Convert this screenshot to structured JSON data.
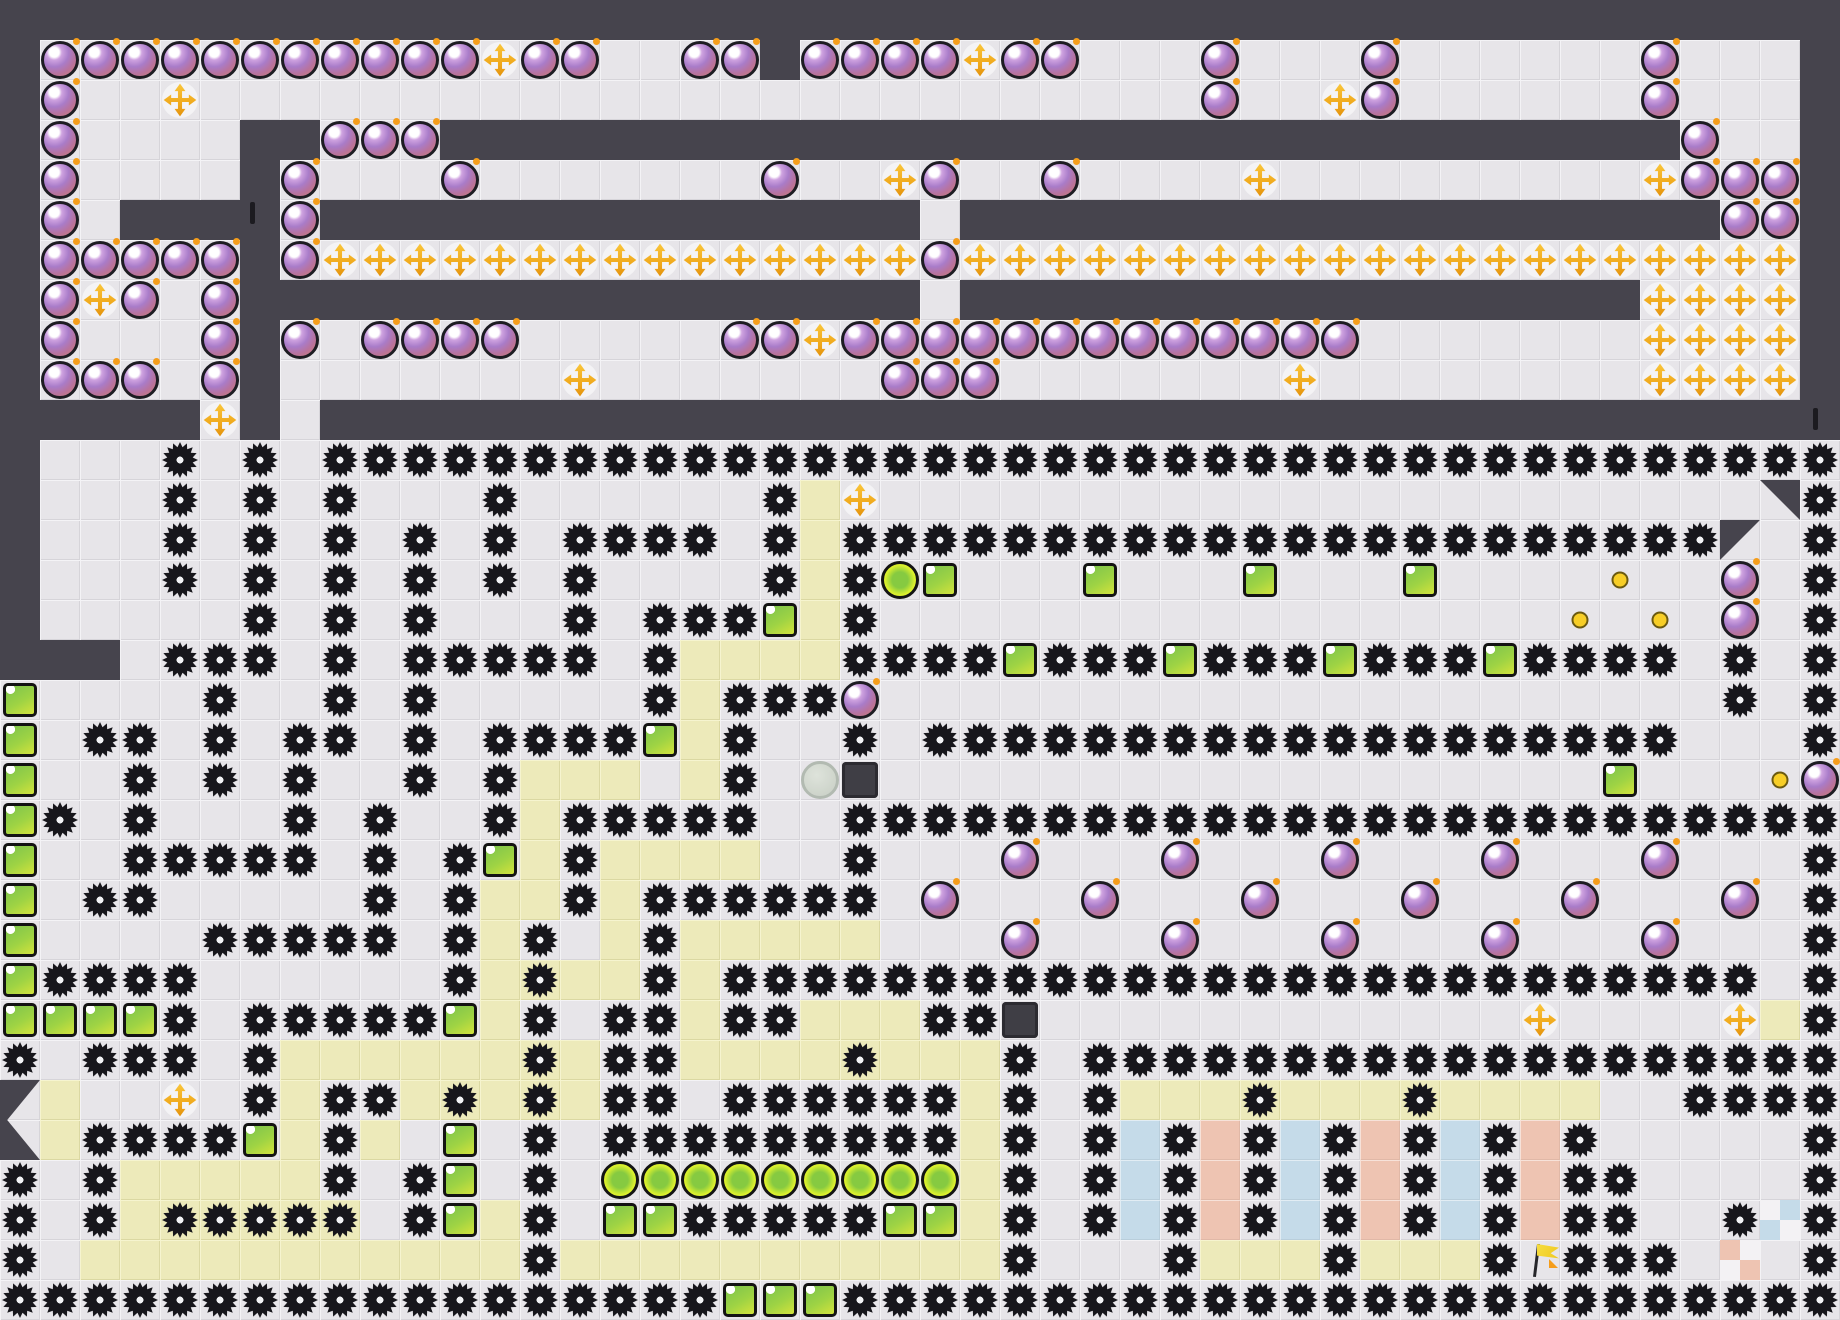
{
  "app": {
    "name": "tile-puzzle-level",
    "view": "full-level-map"
  },
  "board": {
    "cols": 46,
    "rows_count": 33,
    "tile_size": 40,
    "legend": {
      "#": "wall",
      ".": "floor",
      "b": "bomb",
      "+": "powerup-cross",
      "g": "gear-mine",
      "h": "gear-mine-on-path",
      "y": "path",
      "G": "green-block",
      "o": "orb",
      "c": "coin",
      "P": "player-circle",
      "D": "dark-block",
      "F": "checkpoint-flag",
      "B": "blue-tile",
      "S": "salmon-tile",
      "x": "checker-blue-tile",
      "X": "checker-salmon-tile",
      "1": "wedge-ne",
      "2": "wedge-nw",
      "4": "chevron-top",
      "5": "chevron-bottom"
    },
    "rows": [
      "##############################################",
      "#bbbbbbbbbbb+bb..bb#bbbb+bb...b...b......b...#",
      "#b..+.........................b..+b......b...#",
      "#b....##bbb###############################b..#",
      "#b....#b...b.......b..+b..b....+.........+bbb#",
      "#b.####b###############.###################bb#",
      "#bbbbb#b+++++++++++++++b+++++++++++++++++++++#",
      "#b+b.b#################.#################++++#",
      "#b...b#b.bbbb.....bb+bbbbbbbbbbbbb.......++++#",
      "#bbb.b#.......+.......bbb.......+........++++#",
      "#####+#.######################################",
      "#...g.g.gggggggggggggggggggggggggggggggggggggg",
      "#...g.g.g...g......gy+......................1g",
      "#...g.g.g.g.g.gggg.gygggggggggggggggggggggg2.g",
      "#...g.g.g.g.g.g....gygoG...G...G...G....c..b.g",
      "#.....g.g.g...g.gggGyg.................c.c.b.g",
      "###.ggg.g.ggggg.gyyyyggggGgggGgggGgggGgggg.g.g",
      "G....g..g.g.....gygggb.....................g.g",
      "G.gg.g.gg.g.ggggGyg..g.ggggggggggggggggggg...g",
      "G..g.g.g..g.gyyy.yg.PD..................G...cb",
      "Gg.g...g.g..gyggggg..ggggggggggggggggggggggggg",
      "G..ggggg.g.gGygyyyy..g...b...b...b...b...b...g",
      "G.gg.....g.gyygygggggg.b...b...b...b...b...b.g",
      "G....ggggg.gyg.ygyyyyy...b...b...b...b...b...g",
      "Ggggg......gyhyygygggggggggggggggggggggggggg.g",
      "GGGGg.gggggGyg.ggyggyyyggD............+....+yg",
      "g.ggg.gyyyyyyhyggyyyyhyyyg.ggggggggggggggggggg",
      "4y..+.gyggyhyhygg.ggggggyg.gyyyhyyyhyyyy..gggg",
      "5yggggGygy.G.g.gggggggggyg.gBgSgBgSgBgSg.....g",
      "g.gyyyyyg.gG.g.oooooooooyg.gBgSgBgSgBgSgg....g",
      "g.gyhhhhh.gGyg.GGgggggGGyg.gBgSgBgSgBgSgg..gxg",
      "g.yyyyyyyyyyygyyyyyyyyyyyg...gyyygyyygFggg.X.g",
      "ggggggggggggggggggGGGggggggggggggggggggggggggg"
    ],
    "wall_marks": [
      {
        "col": 6,
        "row": 5,
        "dx": 10,
        "dy": -8
      },
      {
        "col": 45,
        "row": 10,
        "dx": 13,
        "dy": -2
      }
    ],
    "entities": {
      "player": {
        "col": 20,
        "row": 19
      },
      "dark_blocks": [
        {
          "col": 21,
          "row": 19
        },
        {
          "col": 25,
          "row": 25
        }
      ],
      "flag": {
        "col": 38,
        "row": 31
      },
      "orb_row": {
        "row": 29,
        "from_col": 15,
        "to_col": 23
      },
      "bottom_green_blocks": {
        "row": 32,
        "cols": [
          18,
          19,
          20
        ]
      }
    }
  },
  "palette": {
    "wall": "#46444d",
    "floor": "#e7e5e9",
    "floor_hi": "#f4f3f6",
    "floor_lo": "#d6d4d9",
    "path": "#edeaba",
    "path_hi": "#f6f4cf",
    "path_lo": "#dbd8a2",
    "pastel_blue": "#c5dbe9",
    "pastel_salmon": "#eec4b2",
    "checker_white": "#f3f2f4",
    "bomb_purple": "#a97cc9",
    "fuse_orange": "#f59d1b",
    "powerup_orange": "#f0a91c",
    "gear_black": "#17161b",
    "green_block": "#9ed344",
    "orb_yellow": "#eef53a",
    "coin_yellow": "#f7ce27",
    "player_gray": "#c9d2c5",
    "flag_yellow": "#f4d32b"
  }
}
